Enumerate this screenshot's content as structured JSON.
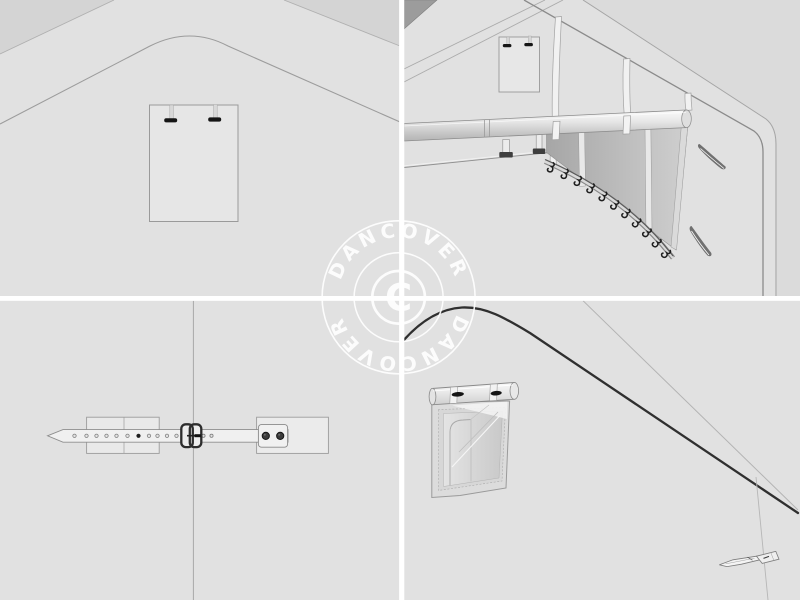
{
  "meta": {
    "type": "product-image-collage",
    "grid": "2x2",
    "brand_watermark": "Dancover"
  },
  "watermark": {
    "ring_text_top": "DANCOVER",
    "ring_text_bottom": "DANCOVER",
    "center_symbol": "C",
    "color": "#ffffff"
  },
  "panels": {
    "top_left": {
      "name": "gable-cover-panel-exterior",
      "description": "Outside view of tent gable end with rectangular access panel held by two black toggle fasteners"
    },
    "top_right": {
      "name": "interior-pole-and-hook-rail",
      "description": "Inside view of tent corner: horizontal frame pole, hanging fastening straps, shaded side panel and lower rail with fixing hooks, wall vents"
    },
    "bottom_left": {
      "name": "strap-buckle-closure",
      "description": "Webbing strap with adjustment eyelets, metal buckle and riveted anchor plate over backing patches"
    },
    "bottom_right": {
      "name": "rolled-door-flap-with-toggles",
      "description": "Rolled-up cover flap fixed by two toggle fasteners above a window opening, corner toggle detail at lower right"
    }
  },
  "colors": {
    "background": "#e1e1e1",
    "corner_shade": "#d4d4d4",
    "dark_shade": "#9c9c9c",
    "outline": "#9a9a9a",
    "fastener_dark": "#151515",
    "rope_dark": "#2f2f2f",
    "divider": "#ffffff",
    "watermark": "#ffffff"
  }
}
